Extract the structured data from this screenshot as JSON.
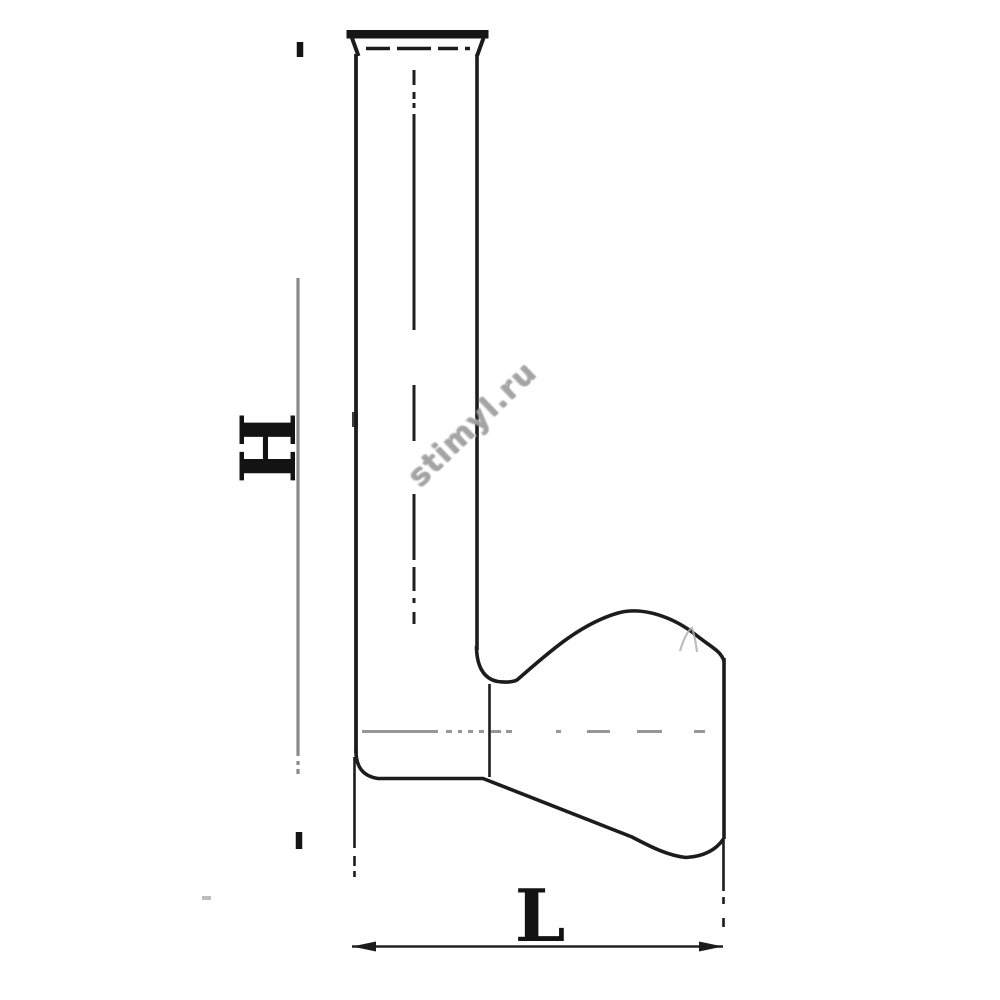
{
  "drawing": {
    "labels": {
      "height_dimension": "H",
      "length_dimension": "L"
    },
    "watermark": "stimyl.ru",
    "colors": {
      "background": "#ffffff",
      "outline": "#1c1c1c",
      "dimension_gray": "#8a8a8a",
      "watermark_gray": "#a0a0a0"
    }
  }
}
